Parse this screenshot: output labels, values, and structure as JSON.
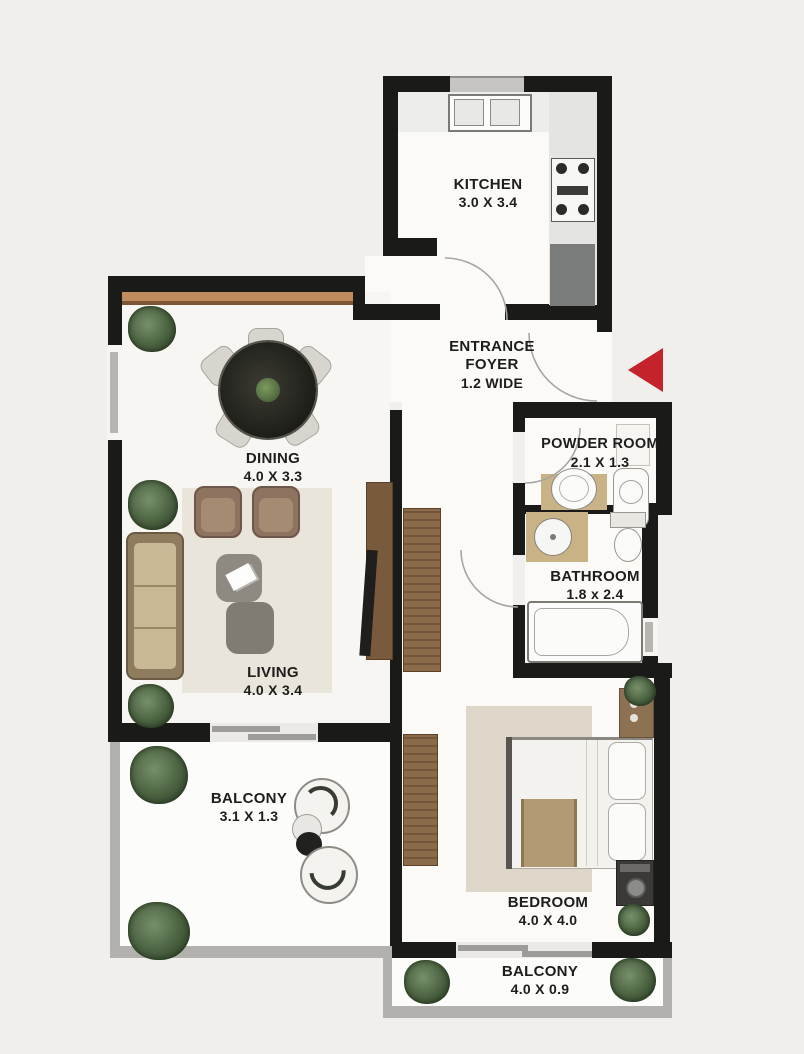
{
  "plan": {
    "title": "apartment-floor-plan",
    "rooms": [
      {
        "id": "kitchen",
        "name": "KITCHEN",
        "dims": "3.0 X 3.4"
      },
      {
        "id": "entrance-foyer",
        "name_line1": "ENTRANCE",
        "name_line2": "FOYER",
        "dims": "1.2 WIDE"
      },
      {
        "id": "powder-room",
        "name": "POWDER ROOM",
        "dims": "2.1 X 1.3"
      },
      {
        "id": "dining",
        "name": "DINING",
        "dims": "4.0 X 3.3"
      },
      {
        "id": "bathroom",
        "name": "BATHROOM",
        "dims": "1.8 x 2.4"
      },
      {
        "id": "living",
        "name": "LIVING",
        "dims": "4.0 X 3.4"
      },
      {
        "id": "balcony-living",
        "name": "BALCONY",
        "dims": "3.1 X 1.3"
      },
      {
        "id": "bedroom",
        "name": "BEDROOM",
        "dims": "4.0 X 4.0"
      },
      {
        "id": "balcony-bedroom",
        "name": "BALCONY",
        "dims": "4.0 X 0.9"
      }
    ],
    "entrance_marker": {
      "shape": "left-pointing-triangle",
      "color": "#c4232b"
    },
    "colors": {
      "wall": "#1a1a18",
      "background": "#f1efec",
      "floor": "#fbfaf7",
      "wood_ledge": "#b8895e",
      "balcony_wall": "#b3b1ad",
      "counter_dark": "#7b7d7c",
      "rug": "#eae5da"
    }
  }
}
